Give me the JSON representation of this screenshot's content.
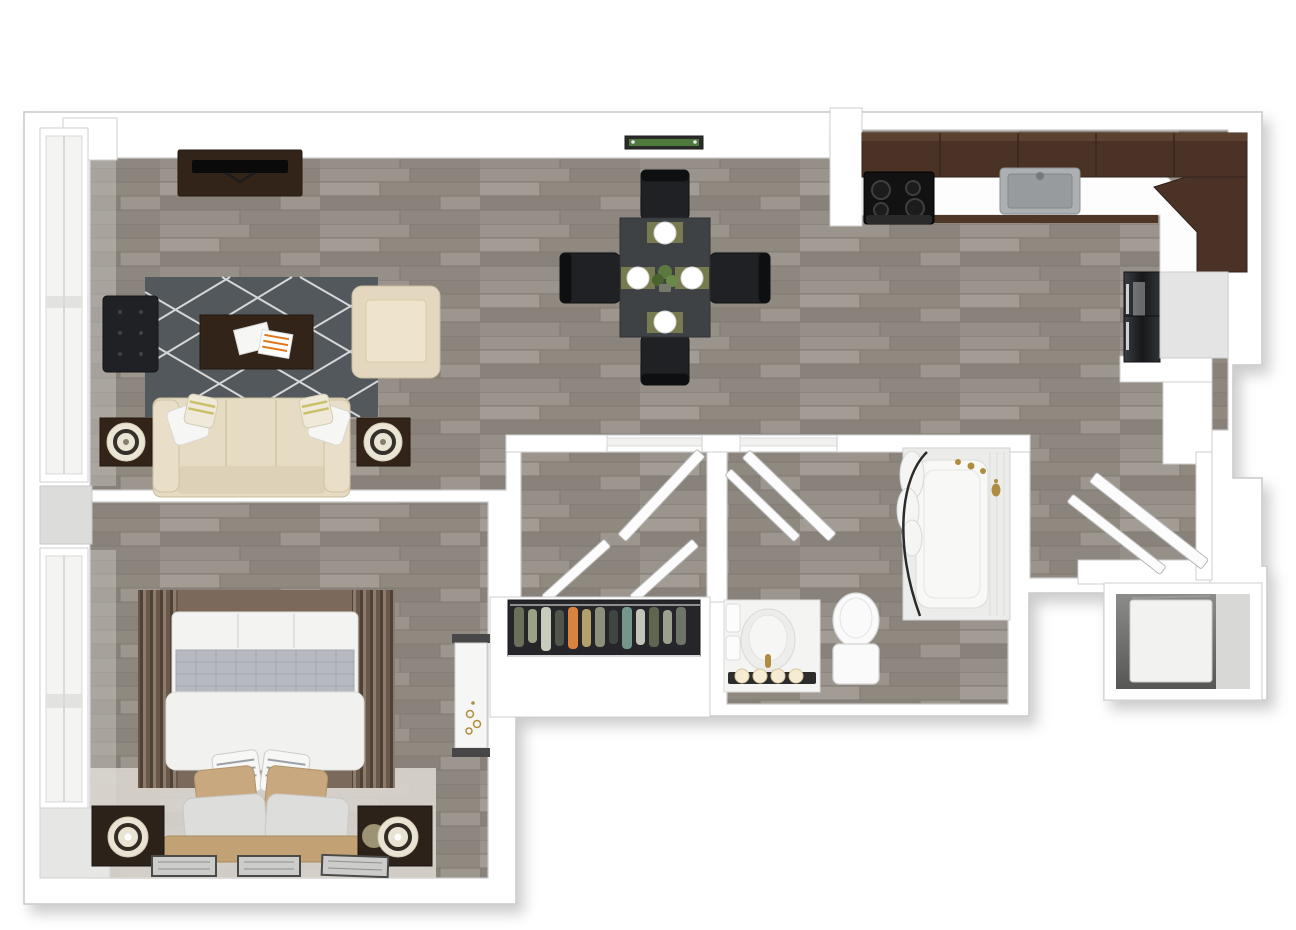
{
  "scene": {
    "type": "3d-floor-plan-top-view",
    "description": "one-bedroom apartment 3D floor plan, no text labels",
    "background": "#ffffff"
  },
  "palette": {
    "wall_white": "#ffffff",
    "wall_outline": "#c8c8c8",
    "wood_base": "#948d85",
    "cabinet_brown": "#4a3326",
    "cabinet_brown_dark": "#32221a",
    "espresso": "#33241a",
    "nightstand_brown": "#2d2219",
    "sofa_beige": "#e6dcc3",
    "armchair_beige": "#e3d8bf",
    "rug_charcoal": "#53585c",
    "rug_line_white": "#e3e4e5",
    "black_furniture": "#202124",
    "dining_table_gray": "#3e4245",
    "placemat_olive": "#777b4f",
    "plant_green": "#4e7a3e",
    "steel_gray": "#adb0b2",
    "fridge_dark": "#26282c",
    "bed_white": "#f3f3f1",
    "bed_throw_gray": "#b6b9c0",
    "pillow_tan": "#c8a87e",
    "headboard_tan": "#c2a274",
    "bedroom_rug_brown": "#7b6a5c",
    "fixture_white": "#fafafa",
    "brass_gold": "#b08d3e",
    "magazine_orange": "#e07820",
    "utility_floor_gray": "#6e6e6e"
  },
  "rooms": {
    "living_room": {
      "furniture": [
        "tv-console",
        "television",
        "area-rug",
        "coffee-table",
        "magazines",
        "tufted-accent-chair",
        "lounge-armchair",
        "sofa",
        "throw-pillows",
        "side-table-left",
        "side-table-right",
        "table-lamp-left",
        "table-lamp-right",
        "window-wall"
      ]
    },
    "dining_area": {
      "furniture": [
        "dining-table",
        "dining-chairs",
        "place-settings",
        "centerpiece-plant",
        "wall-planter"
      ]
    },
    "kitchen": {
      "furniture": [
        "upper-cabinets",
        "corner-cabinet",
        "countertop",
        "cooktop",
        "oven",
        "sink",
        "refrigerator"
      ]
    },
    "hallway": {
      "furniture": [
        "doorway-headers",
        "open-door-leaves"
      ]
    },
    "closet": {
      "furniture": [
        "hanging-clothes",
        "closet-rod",
        "closet-shelf",
        "double-doors"
      ]
    },
    "bathroom": {
      "furniture": [
        "bathtub",
        "tile-surround",
        "curved-shower-rod",
        "shower-curtain",
        "shower-fixture",
        "toilet",
        "vanity",
        "sink-basin",
        "vanity-lights",
        "towels"
      ]
    },
    "bedroom": {
      "furniture": [
        "bed",
        "duvet",
        "throw-blanket",
        "striped-pillows",
        "tan-pillows",
        "gray-pillows",
        "headboard",
        "striped-area-rug",
        "nightstands",
        "sphere-lamps",
        "wall-art-frames",
        "dressing-table",
        "window-wall"
      ]
    },
    "entry": {
      "furniture": [
        "double-entry-doors",
        "threshold",
        "door-frame"
      ]
    },
    "utility_closet": {
      "furniture": [
        "appliance"
      ]
    }
  },
  "counts": {
    "dining_chairs": 4,
    "place_settings": 4,
    "vanity_lights": 4,
    "wall_art_frames": 3,
    "nightstands": 2,
    "table_lamps": 2,
    "entry_door_leaves": 2,
    "closet_door_leaves": 2
  }
}
